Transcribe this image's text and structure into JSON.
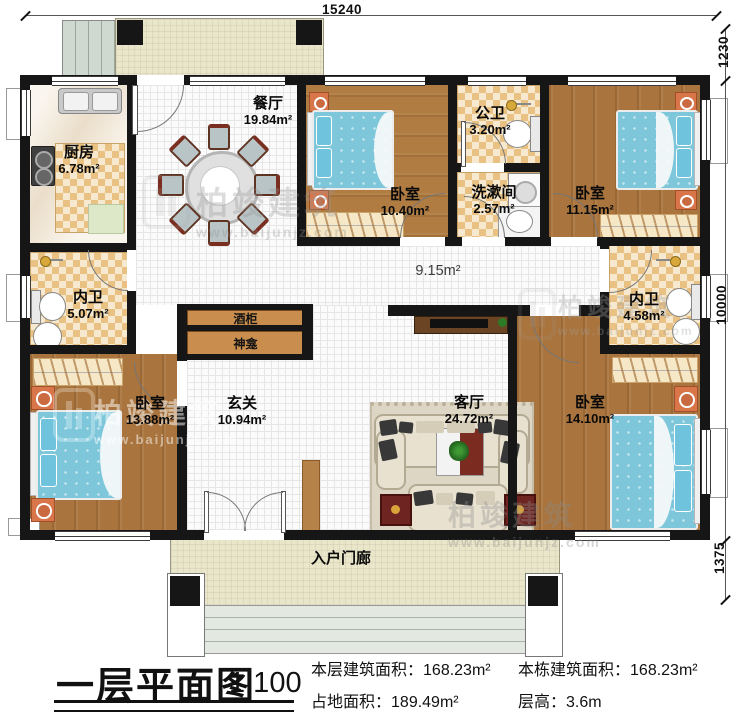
{
  "dimensions": {
    "top": "15240",
    "right_top": "1230",
    "right_main": "10000",
    "right_bottom": "1375"
  },
  "rooms": {
    "kitchen": {
      "name": "厨房",
      "area": "6.78m²"
    },
    "dining": {
      "name": "餐厅",
      "area": "19.84m²"
    },
    "bedroom_top_left": {
      "name": "卧室",
      "area": "10.40m²"
    },
    "public_bath": {
      "name": "公卫",
      "area": "3.20m²"
    },
    "washroom": {
      "name": "洗漱间",
      "area": "2.57m²"
    },
    "bedroom_top_right": {
      "name": "卧室",
      "area": "11.15m²"
    },
    "bath_left": {
      "name": "内卫",
      "area": "5.07m²"
    },
    "corridor": {
      "area": "9.15m²"
    },
    "bath_right": {
      "name": "内卫",
      "area": "4.58m²"
    },
    "bedroom_bottom_left": {
      "name": "卧室",
      "area": "13.88m²"
    },
    "foyer": {
      "name": "玄关",
      "area": "10.94m²"
    },
    "living": {
      "name": "客厅",
      "area": "24.72m²"
    },
    "bedroom_bottom_right": {
      "name": "卧室",
      "area": "14.10m²"
    },
    "porch": {
      "name": "入户门廊"
    }
  },
  "fixtures": {
    "wine_cabinet": "酒柜",
    "shrine": "神龛"
  },
  "footer": {
    "title": "一层平面图",
    "scale": "1:100",
    "stats": [
      {
        "label": "本层建筑面积：",
        "value": "168.23m²"
      },
      {
        "label": "占地面积：",
        "value": "189.49m²"
      },
      {
        "label": "本栋建筑面积：",
        "value": "168.23m²"
      },
      {
        "label": "层高：",
        "value": "3.6m"
      }
    ]
  },
  "watermark": {
    "brand": "柏竣建筑",
    "url": "www.baijunjz.com"
  }
}
